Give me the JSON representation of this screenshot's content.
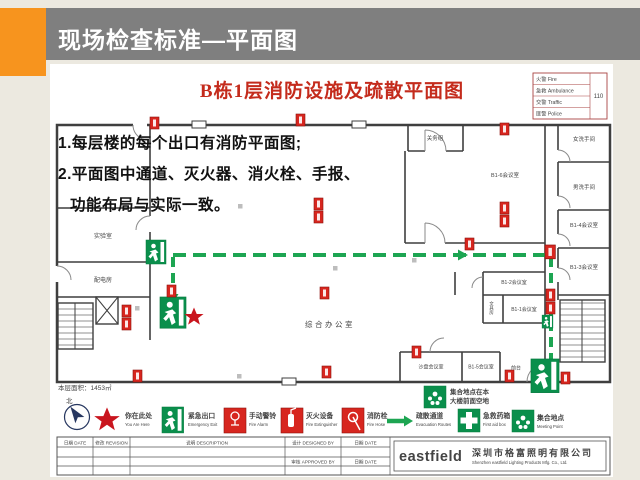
{
  "header": {
    "title": "现场检查标准—平面图"
  },
  "plan": {
    "title": "B栋1层消防设施及疏散平面图",
    "notes": {
      "line1": "1.每层楼的每个出口有消防平面图;",
      "line2": "2.平面图中通道、灭火器、消火栓、手报、",
      "line3": "功能布局与实际一致。"
    },
    "area_label": "本层面积：1453㎡",
    "north_label": "北",
    "emergency_table": {
      "rows": [
        {
          "label": "火警 Fire"
        },
        {
          "label": "急救 Ambulance"
        },
        {
          "label": "交警 Traffic"
        },
        {
          "label": "匪警 Police"
        }
      ],
      "phone": "110"
    },
    "rooms": [
      {
        "label": "实验室"
      },
      {
        "label": "配电房"
      },
      {
        "label": "关务组"
      },
      {
        "label": "B1-6会议室"
      },
      {
        "label": "女洗手间"
      },
      {
        "label": "男洗手间"
      },
      {
        "label": "B1-4会议室"
      },
      {
        "label": "B1-3会议室"
      },
      {
        "label": "综合办公室"
      },
      {
        "label": "B1-2会议室"
      },
      {
        "label": "文具房"
      },
      {
        "label": "B1-1会议室"
      },
      {
        "label": "沙盘会议室"
      },
      {
        "label": "B1-5会议室"
      },
      {
        "label": "前台"
      }
    ],
    "meeting_note": {
      "line1": "集合地点在本",
      "line2": "大楼前面空地"
    }
  },
  "legend": {
    "items": [
      {
        "cn": "你在此处",
        "en": "You Are Here"
      },
      {
        "cn": "紧急出口",
        "en": "Emergency Exit"
      },
      {
        "cn": "手动警铃",
        "en": "Fire Alarm"
      },
      {
        "cn": "灭火设备",
        "en": "Fire Extinguisher"
      },
      {
        "cn": "消防栓",
        "en": "Fire Hose"
      },
      {
        "cn": "疏散通道",
        "en": "Evacuation Routes"
      },
      {
        "cn": "急救药箱",
        "en": "First aid box"
      },
      {
        "cn": "集合地点",
        "en": "Meeting Point"
      }
    ]
  },
  "titleblock": {
    "date1": "日期 DATE",
    "revision": "修改 REVISION",
    "description": "说明 DESCRIPTION",
    "designed": "设计 DESIGNED BY",
    "date2": "日期 DATE",
    "approved": "审核 APPROVED BY",
    "date3": "日期 DATE",
    "logo": "eastfield",
    "company_cn": "深圳市格富照明有限公司",
    "company_en": "Shenzhen eastfield Lighting Products Mfg. Co., Ltd."
  },
  "colors": {
    "accent_orange": "#F7941E",
    "header_gray": "#7F7F7F",
    "plan_red": "#C42B1C",
    "safety_green": "#0A8F4C",
    "route_green": "#1DA552"
  }
}
